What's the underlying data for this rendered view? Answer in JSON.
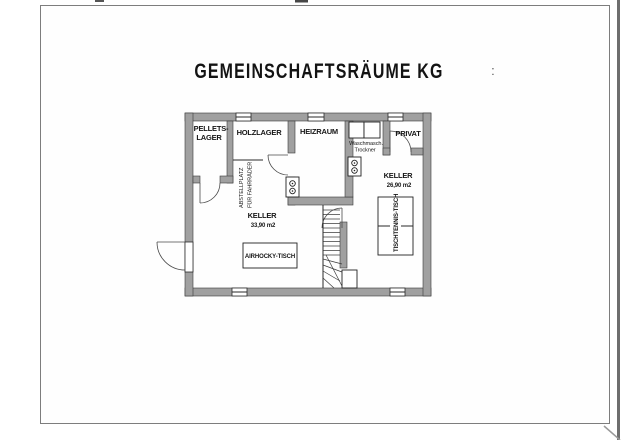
{
  "page": {
    "title": "GEMEINSCHAFTSRÄUME KG",
    "title_mark": ":"
  },
  "floor_plan": {
    "rooms": {
      "pellets_lager": {
        "name_line1": "PELLETS-",
        "name_line2": "LAGER"
      },
      "holzlager": {
        "name": "HOLZLAGER"
      },
      "heizraum": {
        "name": "HEIZRAUM"
      },
      "privat": {
        "name": "PRIVAT"
      },
      "keller_large": {
        "name": "KELLER",
        "area": "33,90 m2"
      },
      "keller_small": {
        "name": "KELLER",
        "area": "26,90 m2"
      }
    },
    "features": {
      "bike_area_line1": "ABSTELLPLATZ",
      "bike_area_line2": "FÜR FAHRRÄDER",
      "washer": "Waschmasch.",
      "dryer": "Trockner",
      "air_hockey_table": "AIRHOCKY-TISCH",
      "table_tennis_table": "TISCHTENNIS-TISCH"
    },
    "colors": {
      "wall_fill": "#a0a0a0",
      "line": "#2a2a2a",
      "text": "#161616",
      "page_frame": "#7d7d7d"
    }
  }
}
